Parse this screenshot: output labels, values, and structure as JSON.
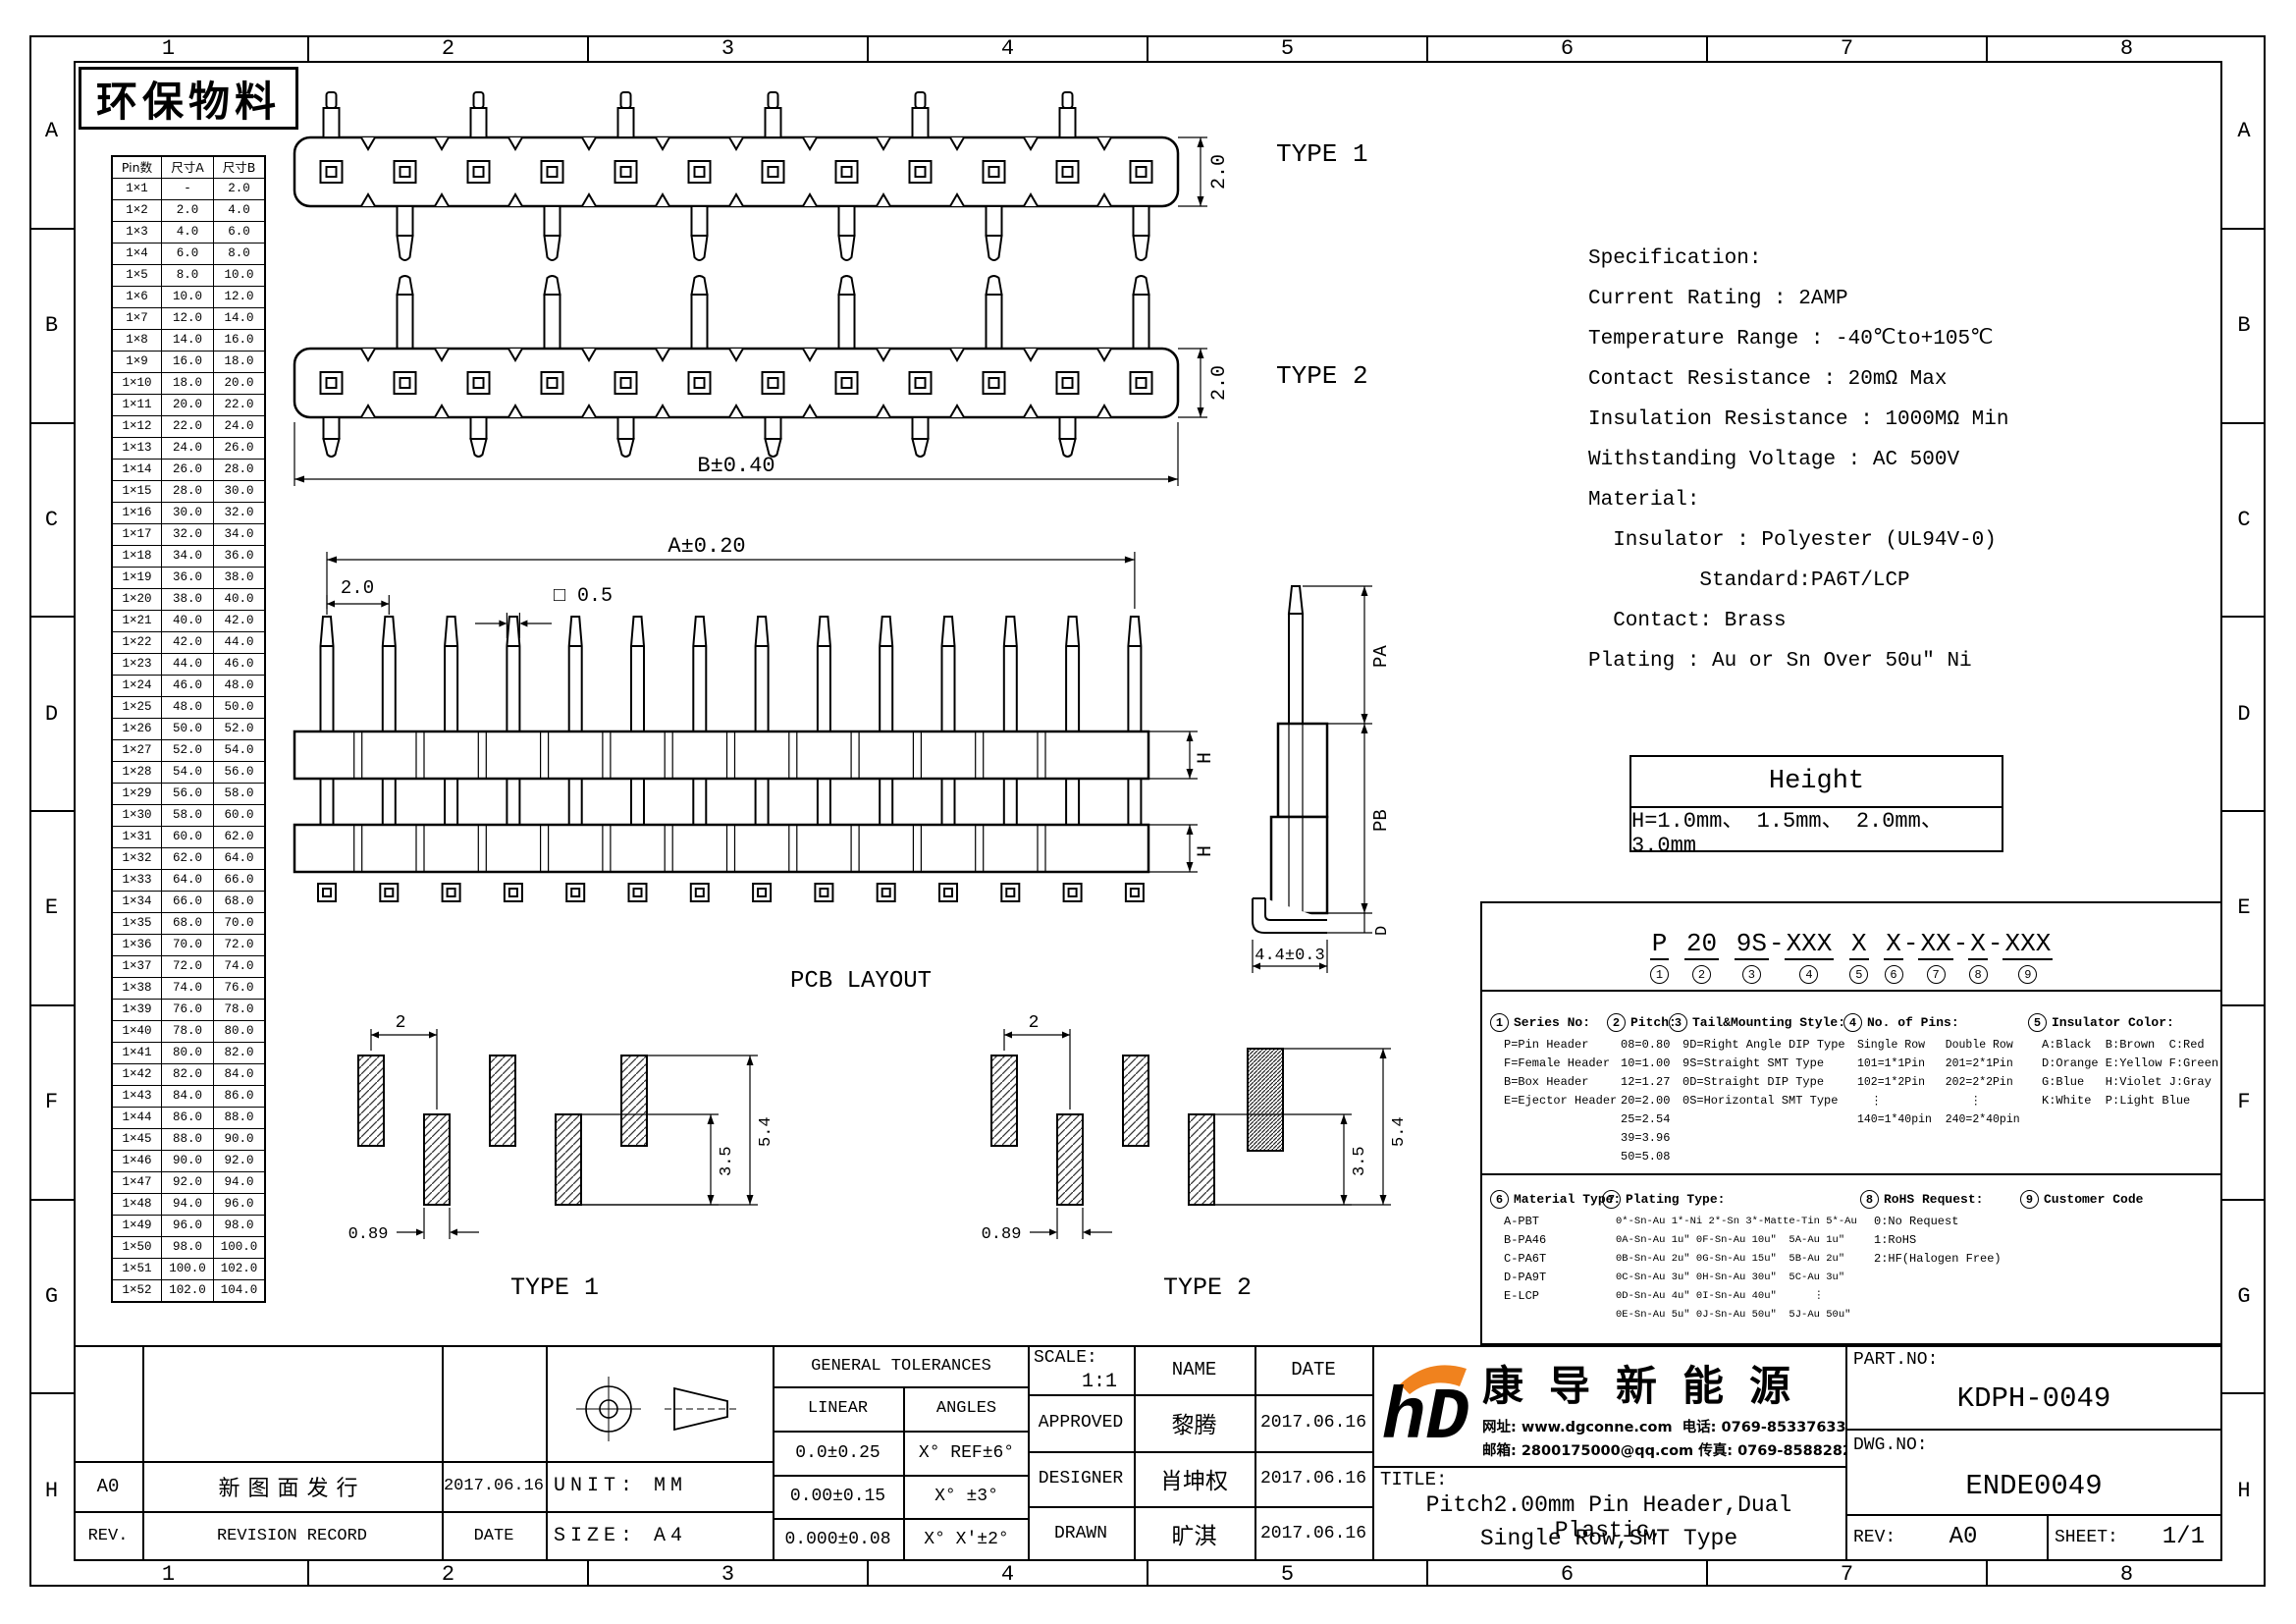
{
  "sheet": {
    "eco_label": "环保物料",
    "zone_cols": [
      "1",
      "2",
      "3",
      "4",
      "5",
      "6",
      "7",
      "8"
    ],
    "zone_rows": [
      "A",
      "B",
      "C",
      "D",
      "E",
      "F",
      "G",
      "H"
    ]
  },
  "pin_table": {
    "headers": [
      "Pin数",
      "尺寸A",
      "尺寸B"
    ],
    "rows": [
      [
        "1×1",
        "-",
        "2.0"
      ],
      [
        "1×2",
        "2.0",
        "4.0"
      ],
      [
        "1×3",
        "4.0",
        "6.0"
      ],
      [
        "1×4",
        "6.0",
        "8.0"
      ],
      [
        "1×5",
        "8.0",
        "10.0"
      ],
      [
        "1×6",
        "10.0",
        "12.0"
      ],
      [
        "1×7",
        "12.0",
        "14.0"
      ],
      [
        "1×8",
        "14.0",
        "16.0"
      ],
      [
        "1×9",
        "16.0",
        "18.0"
      ],
      [
        "1×10",
        "18.0",
        "20.0"
      ],
      [
        "1×11",
        "20.0",
        "22.0"
      ],
      [
        "1×12",
        "22.0",
        "24.0"
      ],
      [
        "1×13",
        "24.0",
        "26.0"
      ],
      [
        "1×14",
        "26.0",
        "28.0"
      ],
      [
        "1×15",
        "28.0",
        "30.0"
      ],
      [
        "1×16",
        "30.0",
        "32.0"
      ],
      [
        "1×17",
        "32.0",
        "34.0"
      ],
      [
        "1×18",
        "34.0",
        "36.0"
      ],
      [
        "1×19",
        "36.0",
        "38.0"
      ],
      [
        "1×20",
        "38.0",
        "40.0"
      ],
      [
        "1×21",
        "40.0",
        "42.0"
      ],
      [
        "1×22",
        "42.0",
        "44.0"
      ],
      [
        "1×23",
        "44.0",
        "46.0"
      ],
      [
        "1×24",
        "46.0",
        "48.0"
      ],
      [
        "1×25",
        "48.0",
        "50.0"
      ],
      [
        "1×26",
        "50.0",
        "52.0"
      ],
      [
        "1×27",
        "52.0",
        "54.0"
      ],
      [
        "1×28",
        "54.0",
        "56.0"
      ],
      [
        "1×29",
        "56.0",
        "58.0"
      ],
      [
        "1×30",
        "58.0",
        "60.0"
      ],
      [
        "1×31",
        "60.0",
        "62.0"
      ],
      [
        "1×32",
        "62.0",
        "64.0"
      ],
      [
        "1×33",
        "64.0",
        "66.0"
      ],
      [
        "1×34",
        "66.0",
        "68.0"
      ],
      [
        "1×35",
        "68.0",
        "70.0"
      ],
      [
        "1×36",
        "70.0",
        "72.0"
      ],
      [
        "1×37",
        "72.0",
        "74.0"
      ],
      [
        "1×38",
        "74.0",
        "76.0"
      ],
      [
        "1×39",
        "76.0",
        "78.0"
      ],
      [
        "1×40",
        "78.0",
        "80.0"
      ],
      [
        "1×41",
        "80.0",
        "82.0"
      ],
      [
        "1×42",
        "82.0",
        "84.0"
      ],
      [
        "1×43",
        "84.0",
        "86.0"
      ],
      [
        "1×44",
        "86.0",
        "88.0"
      ],
      [
        "1×45",
        "88.0",
        "90.0"
      ],
      [
        "1×46",
        "90.0",
        "92.0"
      ],
      [
        "1×47",
        "92.0",
        "94.0"
      ],
      [
        "1×48",
        "94.0",
        "96.0"
      ],
      [
        "1×49",
        "96.0",
        "98.0"
      ],
      [
        "1×50",
        "98.0",
        "100.0"
      ],
      [
        "1×51",
        "100.0",
        "102.0"
      ],
      [
        "1×52",
        "102.0",
        "104.0"
      ]
    ]
  },
  "views": {
    "type1": {
      "label": "TYPE 1",
      "dim_h": "2.0"
    },
    "type2": {
      "label": "TYPE 2",
      "dim_h": "2.0",
      "dim_b": "B±0.40"
    },
    "front": {
      "dim_a": "A±0.20",
      "dim_pitch": "2.0",
      "dim_sq": "□ 0.5",
      "dim_h": "H",
      "pcb_label": "PCB LAYOUT"
    },
    "side": {
      "dim_pa": "PA",
      "dim_pb": "PB",
      "dim_d": "D",
      "dim_foot": "4.4±0.3"
    },
    "layout1": {
      "label": "TYPE 1",
      "dim_pitch": "2",
      "dim_w": "0.89",
      "dim_h1": "3.5",
      "dim_h2": "5.4"
    },
    "layout2": {
      "label": "TYPE 2",
      "dim_pitch": "2",
      "dim_w": "0.89",
      "dim_h1": "3.5",
      "dim_h2": "5.4"
    }
  },
  "specification": {
    "lines": [
      "Specification:",
      "Current Rating : 2AMP",
      "Temperature Range : -40℃to+105℃",
      "Contact Resistance : 20mΩ Max",
      "Insulation Resistance : 1000MΩ Min",
      "Withstanding Voltage : AC 500V",
      "Material:",
      "  Insulator : Polyester (UL94V-0)",
      "         Standard:PA6T/LCP",
      "  Contact: Brass",
      "Plating : Au or Sn Over 50u″ Ni"
    ]
  },
  "height_table": {
    "title": "Height",
    "value": "H=1.0mm、 1.5mm、 2.0mm、 3.0mm"
  },
  "ordering": {
    "part_code": [
      {
        "code": "P",
        "num": "1",
        "sep": " "
      },
      {
        "code": "20",
        "num": "2",
        "sep": " "
      },
      {
        "code": "9S",
        "num": "3",
        "sep": "-"
      },
      {
        "code": "XXX",
        "num": "4",
        "sep": " "
      },
      {
        "code": "X",
        "num": "5",
        "sep": " "
      },
      {
        "code": "X",
        "num": "6",
        "sep": "-"
      },
      {
        "code": "XX",
        "num": "7",
        "sep": "-"
      },
      {
        "code": "X",
        "num": "8",
        "sep": "-"
      },
      {
        "code": "XXX",
        "num": "9",
        "sep": ""
      }
    ],
    "series": {
      "num": "1",
      "title": "Series No:",
      "items": [
        "P=Pin Header",
        "F=Female Header",
        "B=Box Header",
        "E=Ejector Header"
      ]
    },
    "pitch": {
      "num": "2",
      "title": "Pitch:",
      "items": [
        "08=0.80",
        "10=1.00",
        "12=1.27",
        "20=2.00",
        "25=2.54",
        "39=3.96",
        "50=5.08"
      ]
    },
    "tail": {
      "num": "3",
      "title": "Tail&Mounting Style:",
      "items": [
        "9D=Right Angle DIP Type",
        "9S=Straight SMT Type",
        "0D=Straight DIP Type",
        "0S=Horizontal SMT Type"
      ]
    },
    "pins": {
      "num": "4",
      "title": "No. of Pins:",
      "items": [
        "Single Row   Double Row",
        "101=1*1Pin   201=2*1Pin",
        "102=1*2Pin   202=2*2Pin",
        "  ⋮             ⋮",
        "140=1*40pin  240=2*40pin"
      ]
    },
    "color": {
      "num": "5",
      "title": "Insulator Color:",
      "items": [
        "A:Black  B:Brown  C:Red",
        "D:Orange E:Yellow F:Green",
        "G:Blue   H:Violet J:Gray",
        "K:White  P:Light Blue"
      ]
    },
    "material": {
      "num": "6",
      "title": "Material Type:",
      "items": [
        "A-PBT",
        "B-PA46",
        "C-PA6T",
        "D-PA9T",
        "E-LCP"
      ]
    },
    "plating": {
      "num": "7",
      "title": "Plating Type:",
      "items": [
        "0*-Sn-Au 1*-Ni 2*-Sn 3*-Matte-Tin 5*-Au",
        "0A-Sn-Au 1u″ 0F-Sn-Au 10u″  5A-Au 1u″",
        "0B-Sn-Au 2u″ 0G-Sn-Au 15u″  5B-Au 2u″",
        "0C-Sn-Au 3u″ 0H-Sn-Au 30u″  5C-Au 3u″",
        "0D-Sn-Au 4u″ 0I-Sn-Au 40u″      ⋮",
        "0E-Sn-Au 5u″ 0J-Sn-Au 50u″  5J-Au 50u″"
      ]
    },
    "rohs": {
      "num": "8",
      "title": "RoHS Request:",
      "items": [
        "0:No Request",
        "1:RoHS",
        "2:HF(Halogen Free)"
      ]
    },
    "customer": {
      "num": "9",
      "title": "Customer Code",
      "items": []
    }
  },
  "title_block": {
    "general_tolerances": {
      "title": "GENERAL TOLERANCES",
      "linear_label": "LINEAR",
      "angles_label": "ANGLES",
      "rows": [
        [
          "0.0±0.25",
          "X° REF±6°"
        ],
        [
          "0.00±0.15",
          "X° ±3°"
        ],
        [
          "0.000±0.08",
          "X° X'±2°"
        ]
      ]
    },
    "unit_label": "UNIT: MM",
    "size_label": "SIZE: A4",
    "scale_label": "SCALE:",
    "scale_value": "1:1",
    "name_header": "NAME",
    "date_header": "DATE",
    "approved_label": "APPROVED",
    "designer_label": "DESIGNER",
    "drawn_label": "DRAWN",
    "rows": [
      {
        "name": "黎腾",
        "date": "2017.06.16"
      },
      {
        "name": "肖坤权",
        "date": "2017.06.16"
      },
      {
        "name": "旷淇",
        "date": "2017.06.16"
      }
    ],
    "revision": {
      "rev": "A0",
      "record": "新图面发行",
      "date": "2017.06.16",
      "rev_header": "REV.",
      "record_header": "REVISION RECORD",
      "date_header": "DATE"
    },
    "company": {
      "logo": "hD",
      "name": "康导新能源",
      "line1": "网址: www.dgconne.com  电话: 0769-85337633",
      "line2": "邮箱: 2800175000@qq.com 传真: 0769-85882827",
      "brand_blue": "#1FA7E0",
      "brand_orange": "#F0821E"
    },
    "title_label": "TITLE:",
    "title_line1": "Pitch2.00mm Pin Header,Dual Plastic,",
    "title_line2": "Single Row,SMT Type",
    "part_no_label": "PART.NO:",
    "part_no": "KDPH-0049",
    "dwg_no_label": "DWG.NO:",
    "dwg_no": "ENDE0049",
    "rev_label": "REV:",
    "rev": "A0",
    "sheet_label": "SHEET:",
    "sheet": "1/1"
  }
}
